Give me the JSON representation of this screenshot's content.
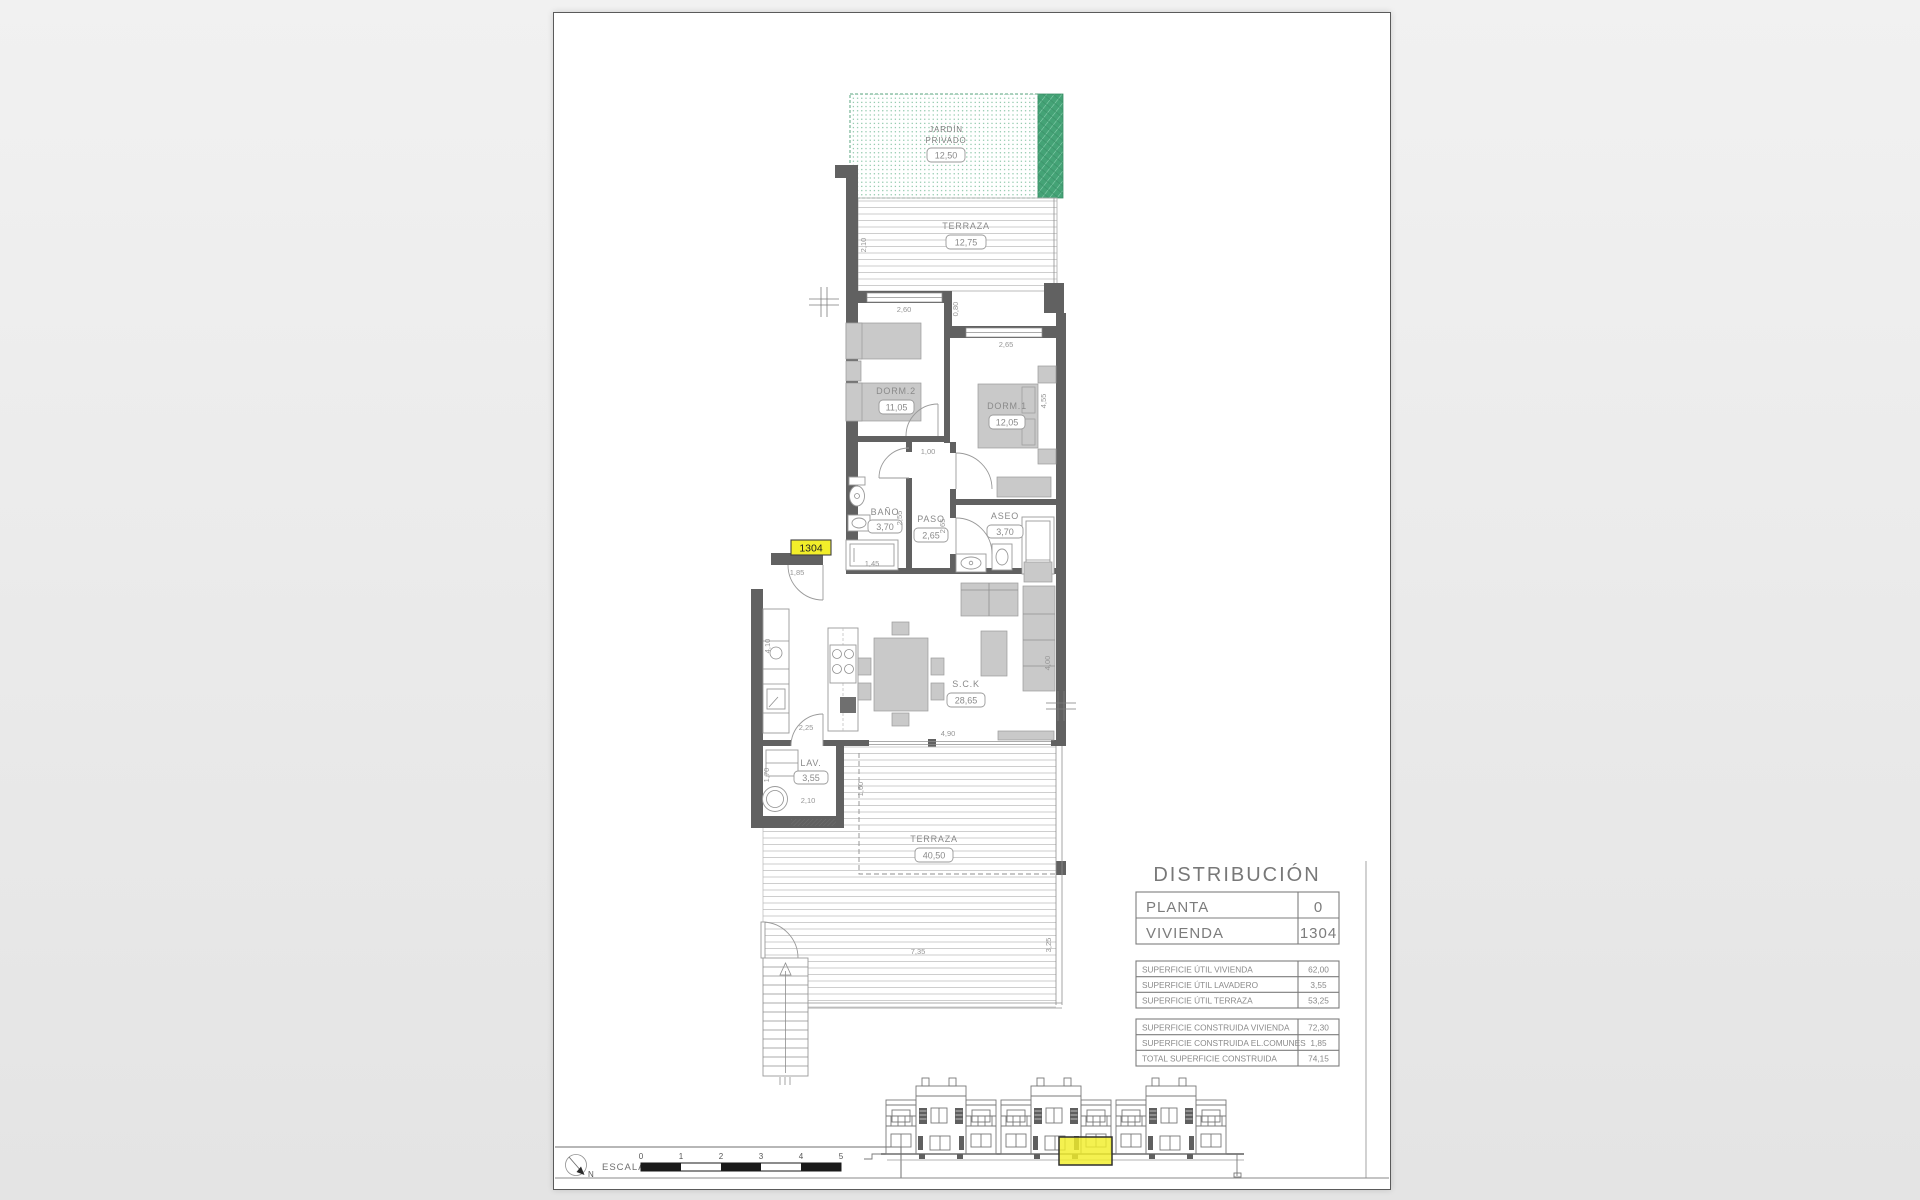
{
  "colors": {
    "wall": "#616161",
    "furniture": "#c9c9c9",
    "yellow": "#f2ee2a",
    "green_solid": "#44a376",
    "green_dot": "#74bb97",
    "deck_line": "#c2c2c2"
  },
  "unit_tag": "1304",
  "rooms": {
    "jardin": {
      "line1": "JARDÍN",
      "line2": "PRIVADO",
      "area": "12,50"
    },
    "terraza1": {
      "name": "TERRAZA",
      "area": "12,75"
    },
    "dorm2": {
      "name": "DORM.2",
      "area": "11,05"
    },
    "dorm1": {
      "name": "DORM.1",
      "area": "12,05"
    },
    "bano": {
      "name": "BAÑO",
      "area": "3,70"
    },
    "paso": {
      "name": "PASO",
      "area": "2,65"
    },
    "aseo": {
      "name": "ASEO",
      "area": "3,70"
    },
    "sck": {
      "name": "S.C.K",
      "area": "28,65"
    },
    "lav": {
      "name": "LAV.",
      "area": "3,55"
    },
    "terraza2": {
      "name": "TERRAZA",
      "area": "40,50"
    }
  },
  "dims": {
    "t1_left": "2,10",
    "d2_top": "2,60",
    "d2_right": "0,80",
    "d1_top": "2,65",
    "d1_right": "4,55",
    "paso_top": "1,00",
    "paso_left": "2,55",
    "paso_right": "2,65",
    "bano_bottom": "1,45",
    "entry": "1,85",
    "kitchen_left": "4,10",
    "kitchen_door": "2,25",
    "living_bottom": "4,90",
    "living_right": "4,00",
    "lav_left": "1,70",
    "lav_bottom": "2,10",
    "t2_left": "1,60",
    "t2_width": "7,35",
    "t2_right": "3,25"
  },
  "distribution": {
    "title": "DISTRIBUCIÓN",
    "main_rows": [
      {
        "label": "PLANTA",
        "value": "0"
      },
      {
        "label": "VIVIENDA",
        "value": "1304"
      }
    ],
    "useful_rows": [
      {
        "label": "SUPERFICIE ÚTIL VIVIENDA",
        "value": "62,00"
      },
      {
        "label": "SUPERFICIE ÚTIL LAVADERO",
        "value": "3,55"
      },
      {
        "label": "SUPERFICIE ÚTIL TERRAZA",
        "value": "53,25"
      }
    ],
    "built_rows": [
      {
        "label": "SUPERFICIE CONSTRUIDA VIVIENDA",
        "value": "72,30"
      },
      {
        "label": "SUPERFICIE CONSTRUIDA EL.COMUNES",
        "value": "1,85"
      },
      {
        "label": "TOTAL SUPERFICIE CONSTRUIDA",
        "value": "74,15"
      }
    ]
  },
  "scale_bar": {
    "label": "ESCALA :",
    "north": "N",
    "ticks": [
      "0",
      "1",
      "2",
      "3",
      "4",
      "5"
    ]
  }
}
